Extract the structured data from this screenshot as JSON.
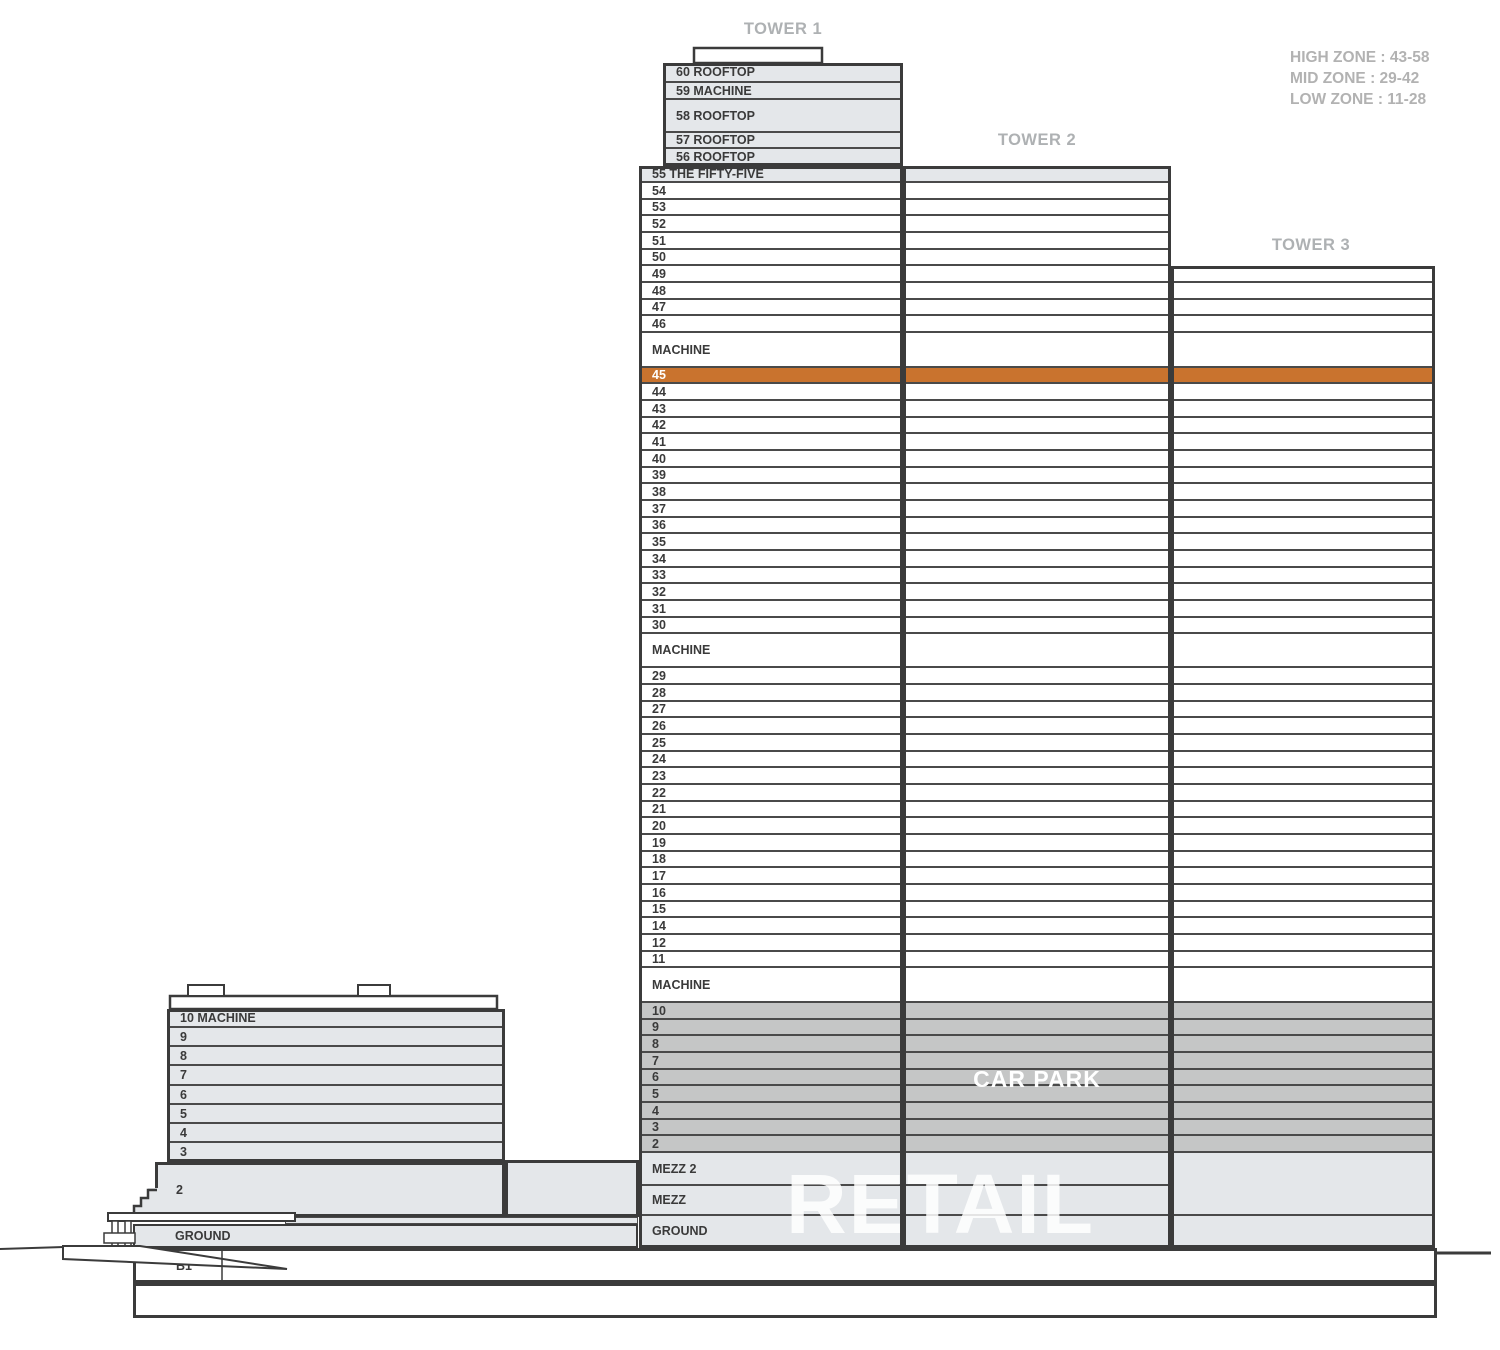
{
  "titles": {
    "tower1": "TOWER 1",
    "tower2": "TOWER 2",
    "tower3": "TOWER 3"
  },
  "legend": {
    "lines": [
      "HIGH ZONE : 43-58",
      "MID ZONE : 29-42",
      "LOW ZONE : 11-28"
    ]
  },
  "overlays": {
    "car_park": "CAR PARK",
    "retail": "RETAIL"
  },
  "highlighted_floor": "45",
  "colors": {
    "floor_light": "#e4e7ea",
    "carpark": "#c5c6c6",
    "highlight": "#c9732e",
    "line_dark": "#3b3b3b",
    "divider": "#4a4a4a",
    "title_text": "#aeb1b3",
    "legend_text": "#b2b2b2",
    "label_text": "#3a3a3a"
  },
  "floors": [
    {
      "l": "60 ROOFTOP",
      "h": 20,
      "f": "light",
      "s": "t1u"
    },
    {
      "l": "59 MACHINE",
      "h": 17,
      "f": "light",
      "s": "t1u"
    },
    {
      "l": "58 ROOFTOP",
      "h": 33,
      "f": "light",
      "s": "t1u"
    },
    {
      "l": "57 ROOFTOP",
      "h": 16,
      "f": "light",
      "s": "t1u"
    },
    {
      "l": "56 ROOFTOP",
      "h": 17,
      "f": "light",
      "s": "t1u"
    },
    {
      "l": "55 THE FIFTY-FIVE",
      "h": 17,
      "f": "light",
      "s": "t12"
    },
    {
      "l": "54",
      "h": 17,
      "f": "white",
      "s": "t12"
    },
    {
      "l": "53",
      "h": 16,
      "f": "white",
      "s": "t12"
    },
    {
      "l": "52",
      "h": 17,
      "f": "white",
      "s": "t12"
    },
    {
      "l": "51",
      "h": 17,
      "f": "white",
      "s": "t12"
    },
    {
      "l": "50",
      "h": 16,
      "f": "white",
      "s": "t12"
    },
    {
      "l": "49",
      "h": 17,
      "f": "white",
      "s": "all"
    },
    {
      "l": "48",
      "h": 17,
      "f": "white",
      "s": "all"
    },
    {
      "l": "47",
      "h": 16,
      "f": "white",
      "s": "all"
    },
    {
      "l": "46",
      "h": 17,
      "f": "white",
      "s": "all"
    },
    {
      "l": "MACHINE",
      "h": 35,
      "f": "white",
      "s": "all"
    },
    {
      "l": "45",
      "h": 16,
      "f": "orange",
      "s": "all"
    },
    {
      "l": "44",
      "h": 17,
      "f": "white",
      "s": "all"
    },
    {
      "l": "43",
      "h": 17,
      "f": "white",
      "s": "all"
    },
    {
      "l": "42",
      "h": 16,
      "f": "white",
      "s": "all"
    },
    {
      "l": "41",
      "h": 17,
      "f": "white",
      "s": "all"
    },
    {
      "l": "40",
      "h": 17,
      "f": "white",
      "s": "all"
    },
    {
      "l": "39",
      "h": 16,
      "f": "white",
      "s": "all"
    },
    {
      "l": "38",
      "h": 17,
      "f": "white",
      "s": "all"
    },
    {
      "l": "37",
      "h": 17,
      "f": "white",
      "s": "all"
    },
    {
      "l": "36",
      "h": 16,
      "f": "white",
      "s": "all"
    },
    {
      "l": "35",
      "h": 17,
      "f": "white",
      "s": "all"
    },
    {
      "l": "34",
      "h": 17,
      "f": "white",
      "s": "all"
    },
    {
      "l": "33",
      "h": 16,
      "f": "white",
      "s": "all"
    },
    {
      "l": "32",
      "h": 17,
      "f": "white",
      "s": "all"
    },
    {
      "l": "31",
      "h": 17,
      "f": "white",
      "s": "all"
    },
    {
      "l": "30",
      "h": 16,
      "f": "white",
      "s": "all"
    },
    {
      "l": "MACHINE",
      "h": 34,
      "f": "white",
      "s": "all"
    },
    {
      "l": "29",
      "h": 17,
      "f": "white",
      "s": "all"
    },
    {
      "l": "28",
      "h": 17,
      "f": "white",
      "s": "all"
    },
    {
      "l": "27",
      "h": 16,
      "f": "white",
      "s": "all"
    },
    {
      "l": "26",
      "h": 17,
      "f": "white",
      "s": "all"
    },
    {
      "l": "25",
      "h": 17,
      "f": "white",
      "s": "all"
    },
    {
      "l": "24",
      "h": 16,
      "f": "white",
      "s": "all"
    },
    {
      "l": "23",
      "h": 17,
      "f": "white",
      "s": "all"
    },
    {
      "l": "22",
      "h": 17,
      "f": "white",
      "s": "all"
    },
    {
      "l": "21",
      "h": 16,
      "f": "white",
      "s": "all"
    },
    {
      "l": "20",
      "h": 17,
      "f": "white",
      "s": "all"
    },
    {
      "l": "19",
      "h": 17,
      "f": "white",
      "s": "all"
    },
    {
      "l": "18",
      "h": 16,
      "f": "white",
      "s": "all"
    },
    {
      "l": "17",
      "h": 17,
      "f": "white",
      "s": "all"
    },
    {
      "l": "16",
      "h": 17,
      "f": "white",
      "s": "all"
    },
    {
      "l": "15",
      "h": 16,
      "f": "white",
      "s": "all"
    },
    {
      "l": "14",
      "h": 17,
      "f": "white",
      "s": "all"
    },
    {
      "l": "12",
      "h": 17,
      "f": "white",
      "s": "all"
    },
    {
      "l": "11",
      "h": 16,
      "f": "white",
      "s": "all"
    },
    {
      "l": "MACHINE",
      "h": 35,
      "f": "white",
      "s": "all"
    },
    {
      "l": "10",
      "h": 17,
      "f": "carpark",
      "s": "all"
    },
    {
      "l": "9",
      "h": 16,
      "f": "carpark",
      "s": "all"
    },
    {
      "l": "8",
      "h": 17,
      "f": "carpark",
      "s": "all"
    },
    {
      "l": "7",
      "h": 17,
      "f": "carpark",
      "s": "all"
    },
    {
      "l": "6",
      "h": 16,
      "f": "carpark",
      "s": "all"
    },
    {
      "l": "5",
      "h": 17,
      "f": "carpark",
      "s": "all"
    },
    {
      "l": "4",
      "h": 17,
      "f": "carpark",
      "s": "all"
    },
    {
      "l": "3",
      "h": 16,
      "f": "carpark",
      "s": "all"
    },
    {
      "l": "2",
      "h": 17,
      "f": "carpark",
      "s": "all"
    },
    {
      "l": "MEZZ 2",
      "h": 33,
      "f": "light",
      "s": "all"
    },
    {
      "l": "MEZZ",
      "h": 30,
      "f": "light",
      "s": "all"
    },
    {
      "l": "GROUND",
      "h": 32,
      "f": "light",
      "s": "all"
    }
  ],
  "podium": {
    "rows": [
      {
        "l": "10 MACHINE",
        "h": 19
      },
      {
        "l": "9",
        "h": 19
      },
      {
        "l": "8",
        "h": 19
      },
      {
        "l": "7",
        "h": 20
      },
      {
        "l": "6",
        "h": 19
      },
      {
        "l": "5",
        "h": 19
      },
      {
        "l": "4",
        "h": 19
      },
      {
        "l": "3",
        "h": 19
      }
    ],
    "floor2_label": "2",
    "ground_label": "GROUND"
  },
  "basement": {
    "b1_label": "B1"
  }
}
